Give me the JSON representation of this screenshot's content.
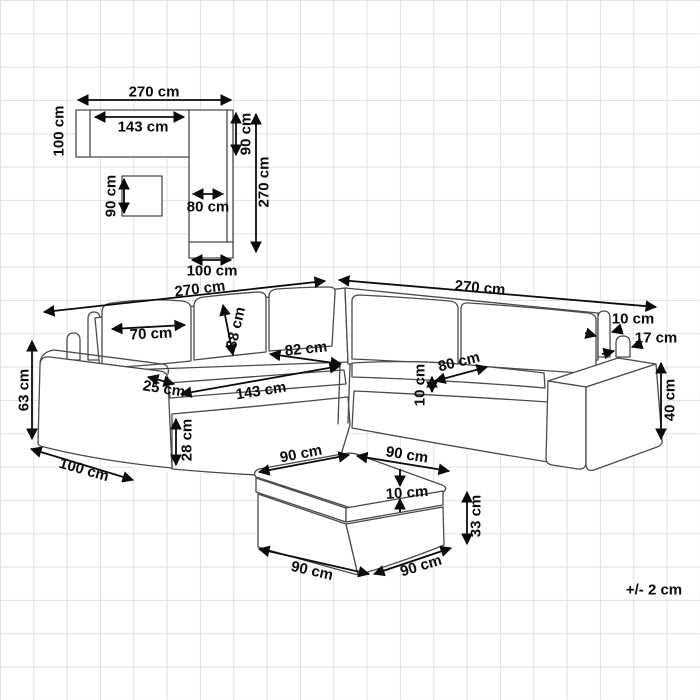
{
  "diagram": {
    "units": "cm",
    "tolerance_note": "+/- 2 cm",
    "plan_view": {
      "labels": [
        {
          "name": "total-width",
          "text": "270 cm"
        },
        {
          "name": "left-depth",
          "text": "100 cm"
        },
        {
          "name": "seat-width",
          "text": "143 cm"
        },
        {
          "name": "corner-back-width",
          "text": "90 cm"
        },
        {
          "name": "total-depth",
          "text": "270 cm"
        },
        {
          "name": "ottoman-size",
          "text": "90 cm"
        },
        {
          "name": "arm-seat-width",
          "text": "80 cm"
        },
        {
          "name": "right-arm-depth",
          "text": "100 cm"
        }
      ]
    },
    "sofa_view": {
      "labels": [
        {
          "name": "left-width",
          "text": "270 cm"
        },
        {
          "name": "right-width",
          "text": "270 cm"
        },
        {
          "name": "back-cushion-width",
          "text": "70 cm"
        },
        {
          "name": "back-cushion-height",
          "text": "38 cm"
        },
        {
          "name": "seat-depth-left",
          "text": "82 cm"
        },
        {
          "name": "seat-width-left",
          "text": "143 cm"
        },
        {
          "name": "armrest-width",
          "text": "25 cm"
        },
        {
          "name": "base-height",
          "text": "28 cm"
        },
        {
          "name": "side-depth",
          "text": "100 cm"
        },
        {
          "name": "seat-height",
          "text": "63 cm"
        },
        {
          "name": "backrest-thickness",
          "text": "10 cm"
        },
        {
          "name": "armrest-back-width",
          "text": "17 cm"
        },
        {
          "name": "seat-depth-right",
          "text": "80 cm"
        },
        {
          "name": "seat-cushion-thickness",
          "text": "10 cm"
        },
        {
          "name": "armrest-height",
          "text": "40 cm"
        }
      ]
    },
    "ottoman_view": {
      "labels": [
        {
          "name": "top-left-edge",
          "text": "90 cm"
        },
        {
          "name": "top-right-edge",
          "text": "90 cm"
        },
        {
          "name": "cushion-thickness",
          "text": "10 cm"
        },
        {
          "name": "height",
          "text": "33 cm"
        },
        {
          "name": "bottom-left-edge",
          "text": "90 cm"
        },
        {
          "name": "bottom-right-edge",
          "text": "90 cm"
        }
      ]
    }
  }
}
